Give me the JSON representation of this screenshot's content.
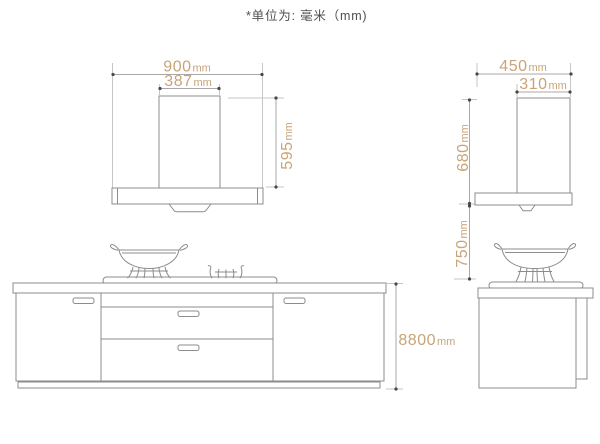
{
  "note": {
    "text": "*单位为: 毫米（mm)"
  },
  "colors": {
    "background": "#ffffff",
    "object_line": "#8c8c8c",
    "dimension_line": "#a8a8a8",
    "extension_line": "#c6c6c6",
    "dimension_text": "#c8a478",
    "note_text": "#4f4f4f",
    "endpoint_dot": "#474747"
  },
  "dimensions": {
    "hood_front_width": {
      "value": "900",
      "unit": "mm"
    },
    "hood_front_chimney_width": {
      "value": "387",
      "unit": "mm"
    },
    "hood_front_height": {
      "value": "595",
      "unit": "mm"
    },
    "hood_side_depth": {
      "value": "450",
      "unit": "mm"
    },
    "hood_side_chimney_depth": {
      "value": "310",
      "unit": "mm"
    },
    "hood_side_height": {
      "value": "680",
      "unit": "mm"
    },
    "hood_to_cooktop_clearance": {
      "value": "750",
      "unit": "mm"
    },
    "cabinet_height": {
      "value": "8800",
      "unit": "mm"
    }
  }
}
